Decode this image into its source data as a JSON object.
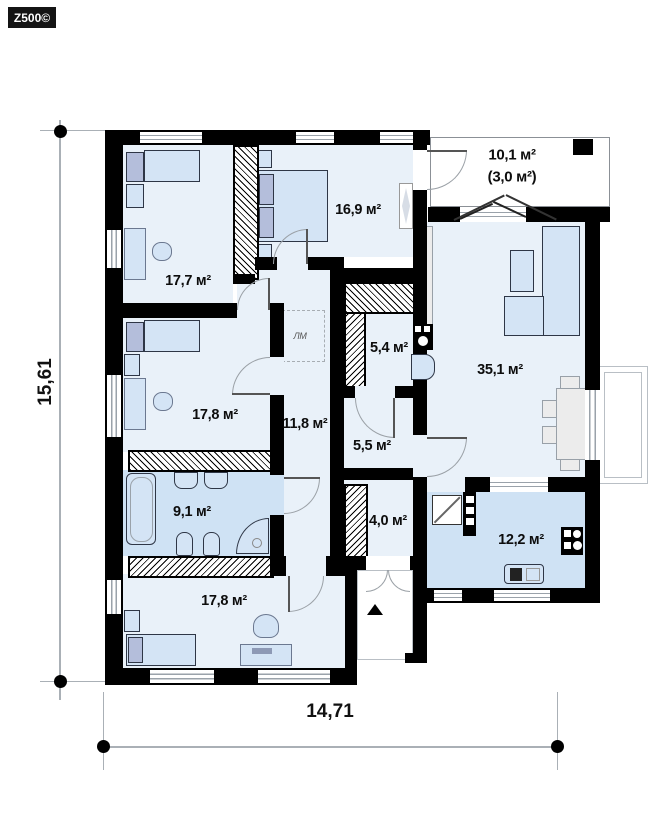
{
  "logo": "Z500©",
  "dimensions": {
    "height_label": "15,61",
    "width_label": "14,71"
  },
  "rooms": {
    "bedroom_top_left": "17,7 м²",
    "bedroom_top_mid": "16,9 м²",
    "terrace": "10,1 м²",
    "terrace_sub": "(3,0 м²)",
    "living": "35,1 м²",
    "bedroom_mid_left": "17,8 м²",
    "hallway": "11,8 м²",
    "pantry": "5,4 м²",
    "hall_small": "5,5 м²",
    "bathroom": "9,1 м²",
    "entry": "4,0 м²",
    "kitchen": "12,2 м²",
    "bedroom_bottom": "17,8 м²",
    "attic_ladder": "ЛМ"
  },
  "colors": {
    "wall": "#000000",
    "room_fill": "#e9f1f9",
    "wet_fill": "#cfe2f4"
  }
}
